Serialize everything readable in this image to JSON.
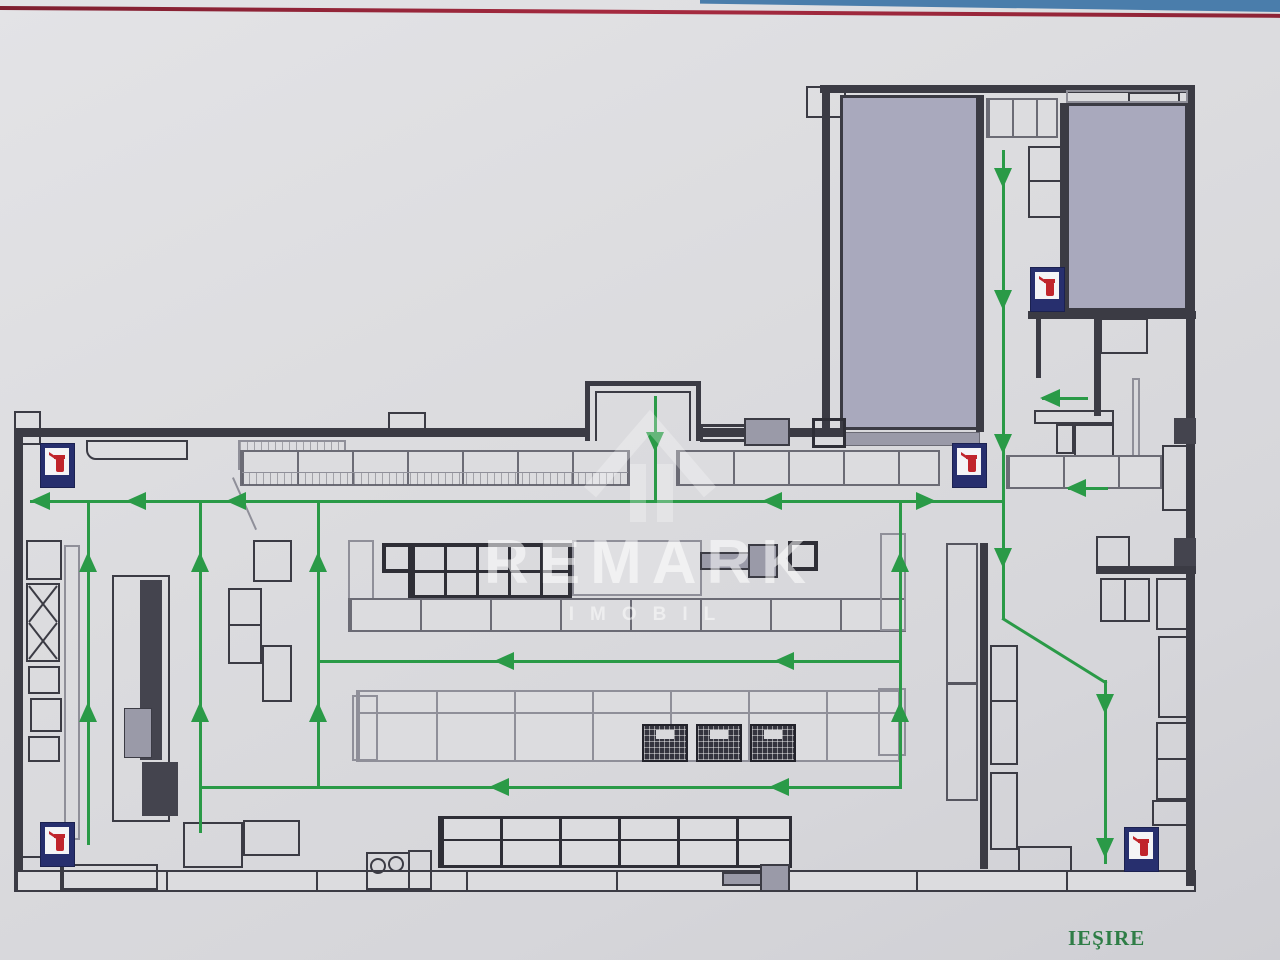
{
  "labels": {
    "exit": "IEŞIRE"
  },
  "watermark": {
    "brand": "REMARK",
    "sub": "IMOBIL"
  },
  "icons": {
    "fire_extinguisher_count": 5
  },
  "colors": {
    "route_green": "#2a9a47",
    "exit_text_green": "#2e7d46",
    "top_edge_red": "#9c2a3c",
    "top_edge_blue": "#4a7dab",
    "room_fill_gray": "#a9a9bd",
    "wall_dark": "#3b3b44",
    "extinguisher_plate_navy": "#272f6e",
    "extinguisher_red": "#c0252c",
    "paper_gray": "#dcdcdf"
  }
}
